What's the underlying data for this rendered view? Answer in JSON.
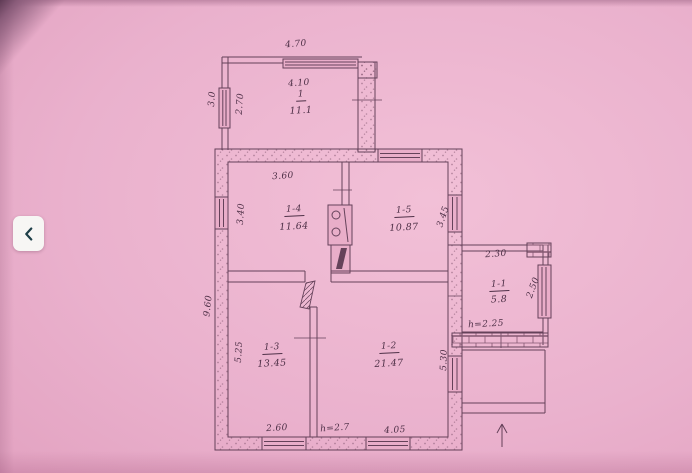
{
  "page": {
    "paper_color": "#eab1cd",
    "ink_color": "#5a3850"
  },
  "back_button": {
    "icon": "chevron-left-icon",
    "glyph": "<",
    "chevron_color": "#1e3f48",
    "background": "#f7f6f4"
  },
  "plan": {
    "rooms": [
      {
        "number": "1",
        "area": "11.1"
      },
      {
        "number": "1-1",
        "area": "5.8"
      },
      {
        "number": "1-2",
        "area": "21.47"
      },
      {
        "number": "1-3",
        "area": "13.45"
      },
      {
        "number": "1-4",
        "area": "11.64"
      },
      {
        "number": "1-5",
        "area": "10.87"
      }
    ],
    "labels": [
      {
        "name": "dim-annex-top-outer",
        "text": "4.70",
        "x": 296,
        "y": 45,
        "rot": -5
      },
      {
        "name": "dim-annex-top-inner",
        "text": "4.10",
        "x": 299,
        "y": 84,
        "rot": -4
      },
      {
        "name": "dim-annex-left-outer",
        "text": "3.0",
        "x": 213,
        "y": 99,
        "rot": -86
      },
      {
        "name": "dim-annex-left-inner",
        "text": "2.70",
        "x": 241,
        "y": 104,
        "rot": -86
      },
      {
        "name": "room-veranda-number",
        "text": "1",
        "x": 301,
        "y": 96,
        "rot": -3,
        "cls": "room-num"
      },
      {
        "name": "room-veranda-area",
        "text": "11.1",
        "x": 301,
        "y": 111,
        "rot": -3,
        "cls": "room-area"
      },
      {
        "name": "dim-room4-width",
        "text": "3.60",
        "x": 283,
        "y": 177,
        "rot": -4
      },
      {
        "name": "dim-room4-depth",
        "text": "3.40",
        "x": 242,
        "y": 214,
        "rot": -87
      },
      {
        "name": "room-4-number",
        "text": "1-4",
        "x": 294,
        "y": 211,
        "rot": -3,
        "cls": "room-num"
      },
      {
        "name": "room-4-area",
        "text": "11.64",
        "x": 294,
        "y": 227,
        "rot": -3,
        "cls": "room-area"
      },
      {
        "name": "room-5-number",
        "text": "1-5",
        "x": 404,
        "y": 212,
        "rot": -3,
        "cls": "room-num"
      },
      {
        "name": "room-5-area",
        "text": "10.87",
        "x": 404,
        "y": 228,
        "rot": -3,
        "cls": "room-area"
      },
      {
        "name": "dim-room5-depth",
        "text": "3.45",
        "x": 444,
        "y": 217,
        "rot": -72
      },
      {
        "name": "dim-left-outer",
        "text": "9.60",
        "x": 209,
        "y": 306,
        "rot": -84
      },
      {
        "name": "dim-room3-depth",
        "text": "5.25",
        "x": 240,
        "y": 352,
        "rot": -87
      },
      {
        "name": "room-3-number",
        "text": "1-3",
        "x": 272,
        "y": 349,
        "rot": -3,
        "cls": "room-num"
      },
      {
        "name": "room-3-area",
        "text": "13.45",
        "x": 272,
        "y": 364,
        "rot": -3,
        "cls": "room-area"
      },
      {
        "name": "room-2-number",
        "text": "1-2",
        "x": 389,
        "y": 348,
        "rot": -3,
        "cls": "room-num"
      },
      {
        "name": "room-2-area",
        "text": "21.47",
        "x": 389,
        "y": 364,
        "rot": -3,
        "cls": "room-area"
      },
      {
        "name": "dim-room2-depth",
        "text": "5.30",
        "x": 445,
        "y": 360,
        "rot": -88
      },
      {
        "name": "dim-room3-bottom",
        "text": "2.60",
        "x": 277,
        "y": 429,
        "rot": -3
      },
      {
        "name": "ceiling-height-main",
        "text": "h=2.7",
        "x": 335,
        "y": 429,
        "rot": -4
      },
      {
        "name": "dim-room2-bottom",
        "text": "4.05",
        "x": 395,
        "y": 431,
        "rot": -3
      },
      {
        "name": "dim-annex2-top",
        "text": "2.30",
        "x": 496,
        "y": 255,
        "rot": -4
      },
      {
        "name": "room-1-number",
        "text": "1-1",
        "x": 499,
        "y": 286,
        "rot": -3,
        "cls": "room-num"
      },
      {
        "name": "room-1-area",
        "text": "5.8",
        "x": 499,
        "y": 300,
        "rot": -3,
        "cls": "room-area"
      },
      {
        "name": "dim-annex2-right",
        "text": "2.50",
        "x": 534,
        "y": 288,
        "rot": -70
      },
      {
        "name": "ceiling-height-annex",
        "text": "h=2.25",
        "x": 486,
        "y": 325,
        "rot": -3
      }
    ]
  }
}
